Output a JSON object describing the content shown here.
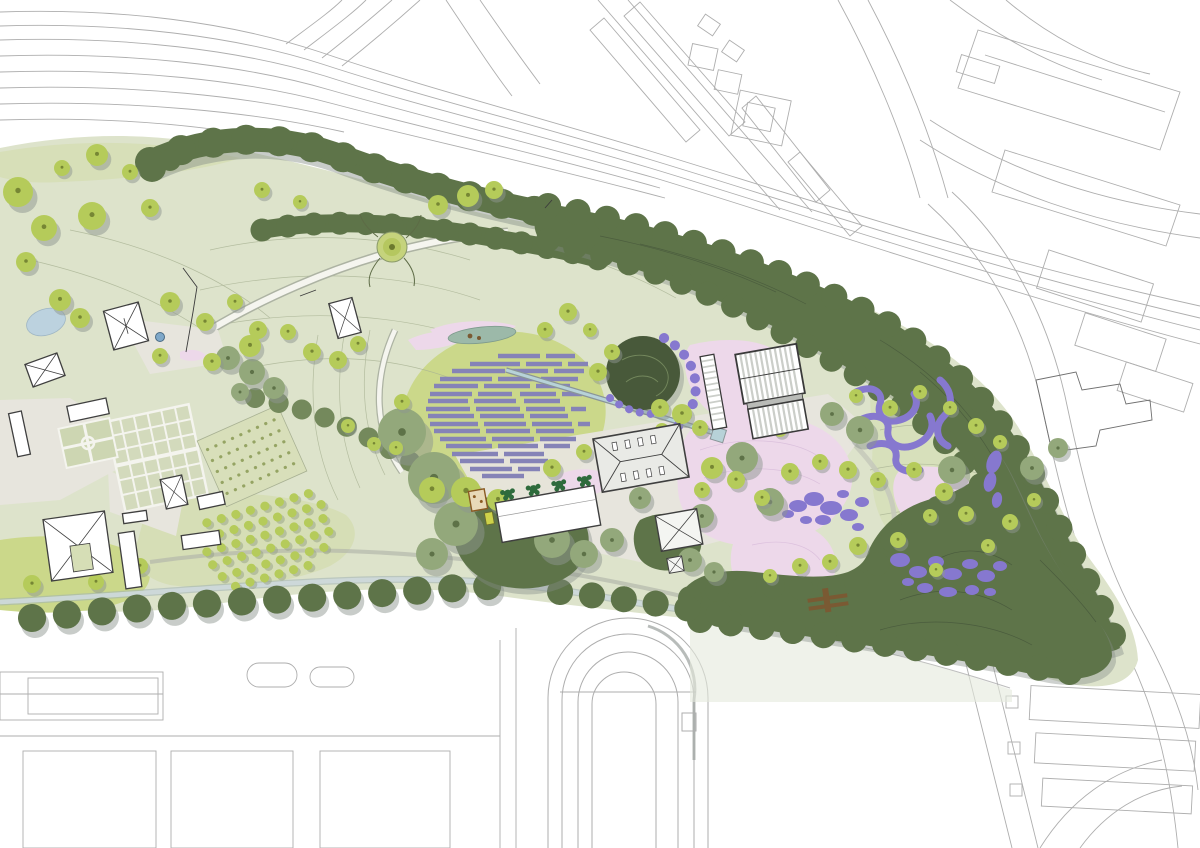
{
  "document": {
    "title": "Landscape masterplan site plan",
    "view": "top-down rendered plan of a park within urban context",
    "visible_text": "none"
  },
  "colors": {
    "background": "#ffffff",
    "context_line": "#aeaeae",
    "context_line_dark": "#6f6f6f",
    "park_base": "#dde3cb",
    "lawn_bright": "#cbd88a",
    "lawn_soft": "#d6deb6",
    "contour": "#a9b394",
    "woodland": "#5e7449",
    "woodland_dark": "#48593a",
    "tree_bright": "#b5cb5a",
    "tree_olive": "#93a87b",
    "hedgerow": "#74895c",
    "canopy_shadow": "#8d958f",
    "lavender_rows": "#8583b7",
    "purple_planting": "#8678cf",
    "pink_planting": "#edd8ea",
    "pond_blue": "#bcd2df",
    "rill_water": "#b7d2d8",
    "teal_pond": "#9cb9a9",
    "stream": "#cdd9da",
    "path_white": "#f5f5ef",
    "paving": "#e7e5dd",
    "building_outline": "#3f3f3f",
    "roof_gray": "#e9eae6",
    "glass_stripe": "#cbcec9",
    "bridge_brown": "#7a5a33",
    "fountain_blue": "#7fa8c9",
    "topiary_green": "#2e6b3c"
  },
  "features": [
    "context-roads-and-rail",
    "context-buildings",
    "perimeter-woodland-belt",
    "southeast-forest",
    "central-meadow-contours",
    "viewing-mound",
    "lavender-field-rows",
    "water-rill",
    "teal-pond",
    "west-pond",
    "fountain",
    "estate-buildings",
    "formal-garden-grid",
    "parterre-garden",
    "allotment-parcel",
    "orchard-rows",
    "main-hall-building",
    "long-barn-building",
    "pavilion-building",
    "glasshouses",
    "pink-planting-gardens",
    "purple-planting-blobs",
    "purple-ribbon-planting",
    "scattered-trees",
    "south-stream",
    "timber-bridge",
    "athletics-track",
    "sports-fields"
  ]
}
